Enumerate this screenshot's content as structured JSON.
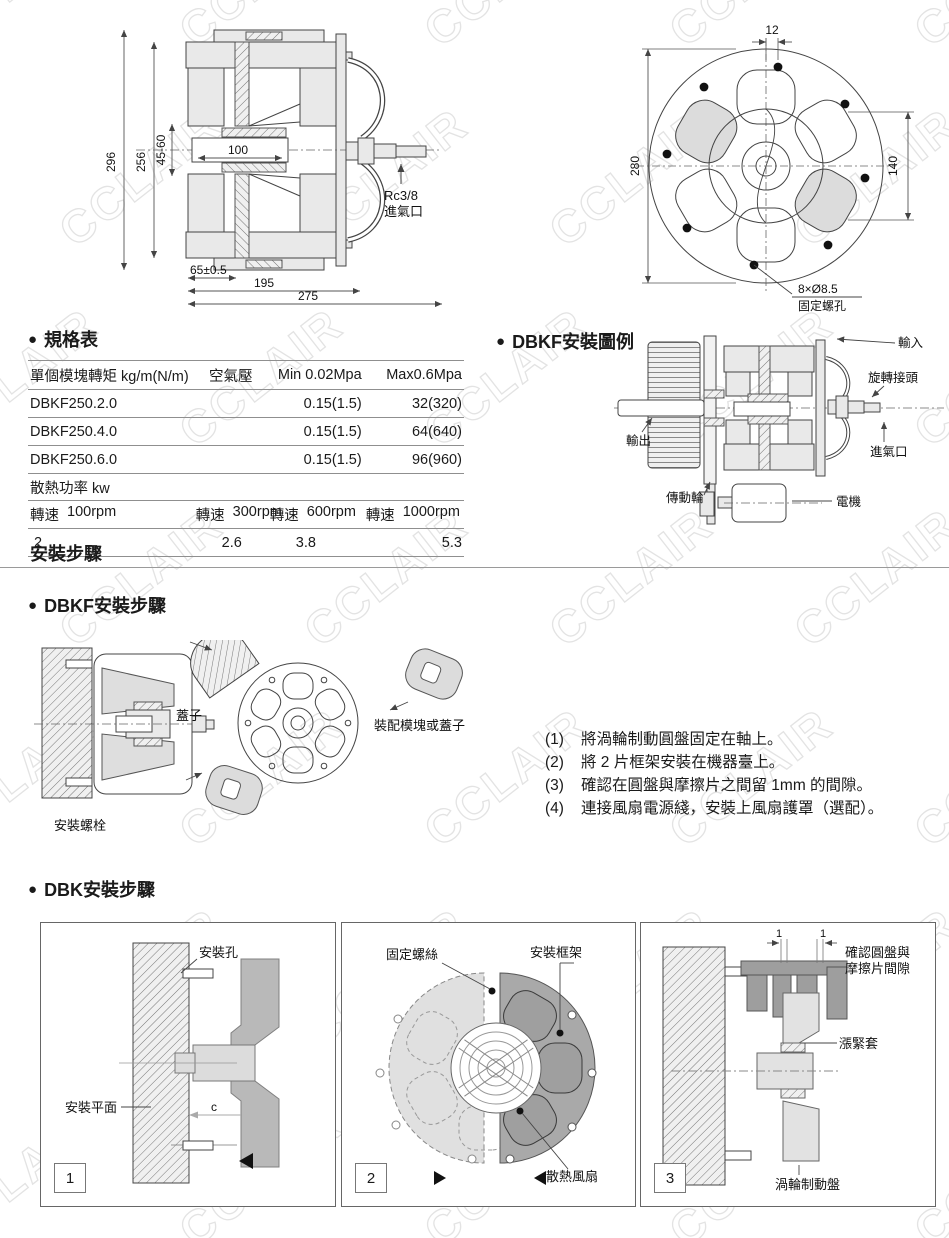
{
  "watermark": {
    "text": "CCLAIR"
  },
  "drawings": {
    "section_view": {
      "d296": "296",
      "d256": "256",
      "d45_60": "45-60",
      "d100": "100",
      "d65": "65±0.5",
      "d195": "195",
      "d275": "275",
      "port_line1": "Rc3/8",
      "port_line2": "進氣口"
    },
    "front_view": {
      "d12": "12",
      "d280": "280",
      "d140": "140",
      "holes_line1": "8×Ø8.5",
      "holes_line2": "固定螺孔"
    }
  },
  "spec": {
    "bullet": "●",
    "title": "規格表",
    "table": {
      "h1": "單個模塊轉矩 kg/m(N/m)",
      "h2": "空氣壓",
      "h3": "Min 0.02Mpa",
      "h4": "Max0.6Mpa",
      "rows": [
        {
          "model": "DBKF250.2.0",
          "air": "",
          "min": "0.15(1.5)",
          "max": "32(320)"
        },
        {
          "model": "DBKF250.4.0",
          "air": "",
          "min": "0.15(1.5)",
          "max": "64(640)"
        },
        {
          "model": "DBKF250.6.0",
          "air": "",
          "min": "0.15(1.5)",
          "max": "96(960)"
        }
      ],
      "power_label": "散熱功率  kw",
      "speeds": [
        {
          "label": "轉速",
          "rpm": "100rpm",
          "value": "2"
        },
        {
          "label": "轉速",
          "rpm": "300rpm",
          "value": "2.6"
        },
        {
          "label": "轉速",
          "rpm": "600rpm",
          "value": "3.8"
        },
        {
          "label": "轉速",
          "rpm": "1000rpm",
          "value": "5.3"
        }
      ]
    }
  },
  "example": {
    "bullet": "●",
    "title": "DBKF安裝圖例",
    "labels": {
      "input": "輸入",
      "rotary_joint": "旋轉接頭",
      "air_inlet": "進氣口",
      "output": "輸出",
      "drive_wheel": "傳動輪",
      "motor": "電機"
    }
  },
  "install": {
    "section_title": "安裝步驟",
    "dbkf": {
      "bullet": "●",
      "title": "DBKF安裝步驟",
      "labels": {
        "cover": "蓋子",
        "module_or_cover": "裝配模塊或蓋子",
        "mount_bolt": "安裝螺栓"
      },
      "steps": [
        {
          "no": "(1)",
          "text": "將渦輪制動圓盤固定在軸上。"
        },
        {
          "no": "(2)",
          "text": "將 2 片框架安裝在機器臺上。"
        },
        {
          "no": "(3)",
          "text": "確認在圓盤與摩擦片之間留 1mm 的間隙。"
        },
        {
          "no": "(4)",
          "text": "連接風扇電源綫，安裝上風扇護罩（選配）。"
        }
      ]
    },
    "dbk": {
      "bullet": "●",
      "title": "DBK安裝步驟",
      "panel1": {
        "no": "1",
        "mount_hole": "安裝孔",
        "mount_surface": "安裝平面",
        "gap": "c"
      },
      "panel2": {
        "no": "2",
        "fix_screw": "固定螺絲",
        "mount_frame": "安裝框架",
        "cooling_fan": "散熱風扇"
      },
      "panel3": {
        "no": "3",
        "tick1": "1",
        "tick2": "1",
        "check1": "確認圓盤與",
        "check2": "摩擦片間隙",
        "sleeve": "漲緊套",
        "disc": "渦輪制動盤"
      }
    }
  }
}
